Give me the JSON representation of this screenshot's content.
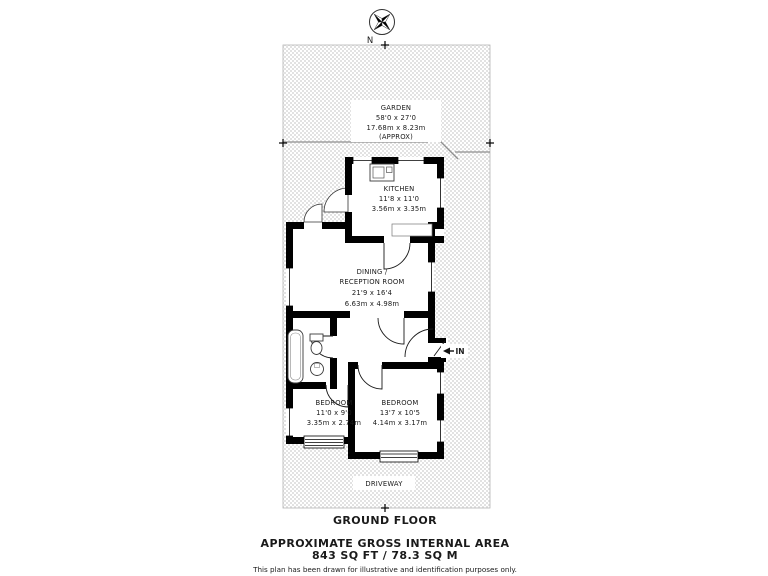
{
  "compass": {
    "north": "N"
  },
  "rooms": {
    "garden": {
      "name": "GARDEN",
      "imperial": "58'0 x 27'0",
      "metric": "17.68m x 8.23m",
      "approx": "(APPROX)"
    },
    "kitchen": {
      "name": "KITCHEN",
      "imperial": "11'8 x 11'0",
      "metric": "3.56m x 3.35m"
    },
    "dining": {
      "name1": "DINING /",
      "name2": "RECEPTION ROOM",
      "imperial": "21'9 x 16'4",
      "metric": "6.63m x 4.98m"
    },
    "bedroom1": {
      "name": "BEDROOM",
      "imperial": "11'0 x 9'0",
      "metric": "3.35m x 2.74m"
    },
    "bedroom2": {
      "name": "BEDROOM",
      "imperial": "13'7 x 10'5",
      "metric": "4.14m x 3.17m"
    },
    "driveway": {
      "name": "DRIVEWAY"
    },
    "entrance": {
      "label": "IN"
    }
  },
  "footer": {
    "floor_label": "GROUND FLOOR",
    "area_title": "APPROXIMATE GROSS INTERNAL AREA",
    "area_value": "843 SQ FT / 78.3 SQ M",
    "disclaimer": "This plan has been drawn for illustrative and identification purposes only."
  },
  "colors": {
    "wall": "#000000",
    "hatch": "#e2e2e2",
    "background": "#ffffff"
  }
}
